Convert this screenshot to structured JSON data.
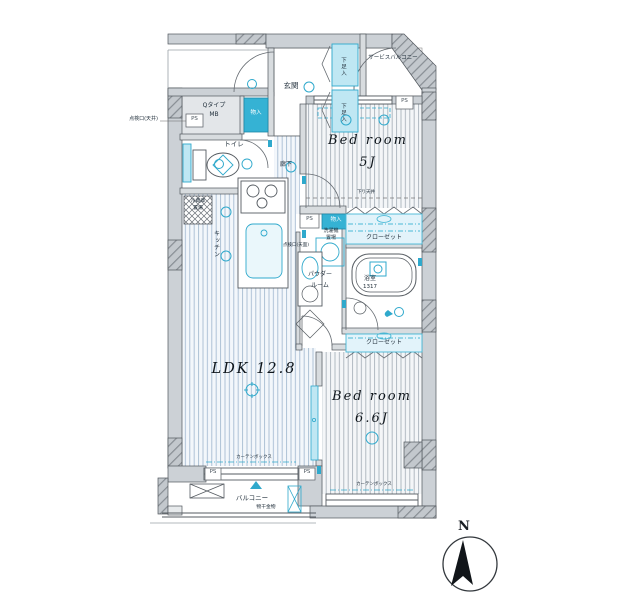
{
  "labels": {
    "genkan": "玄関",
    "shoe": "下足入",
    "service_balcony": "サービスバルコニー",
    "bed5_name": "Bed room",
    "bed5_size": "5J",
    "mb1": "Qタイプ",
    "mb2": "MB",
    "ps": "PS",
    "inspection_ceiling": "点検口(天井)",
    "storage": "物入",
    "toilet": "トイレ",
    "fridge1": "冷蔵庫",
    "fridge2": "置場",
    "kitchen": "キッチン",
    "corridor": "廊下",
    "laundry1": "洗濯機",
    "laundry2": "置場",
    "inspection_top": "点検口(天面)",
    "closet": "クローゼット",
    "powder1": "パウダー",
    "powder2": "ルーム",
    "bath": "浴室",
    "bath_size": "1317",
    "ldk": "LDK 12.8",
    "bed66_name": "Bed room",
    "bed66_size": "6.6J",
    "balcony": "バルコニー",
    "laundry_hardware": "物干金物",
    "curtain_box": "カーテンボックス",
    "lowered_ceiling": "下り天井",
    "compass_north": "N"
  },
  "colors": {
    "accent": "#2fa9cc",
    "accent_fill": "#bfe7f3",
    "wall": "#ccd1d6",
    "hatch": "#878d93",
    "floor_line_blue": "#a6bcd2",
    "floor_line_gray": "#a9b2bb"
  }
}
